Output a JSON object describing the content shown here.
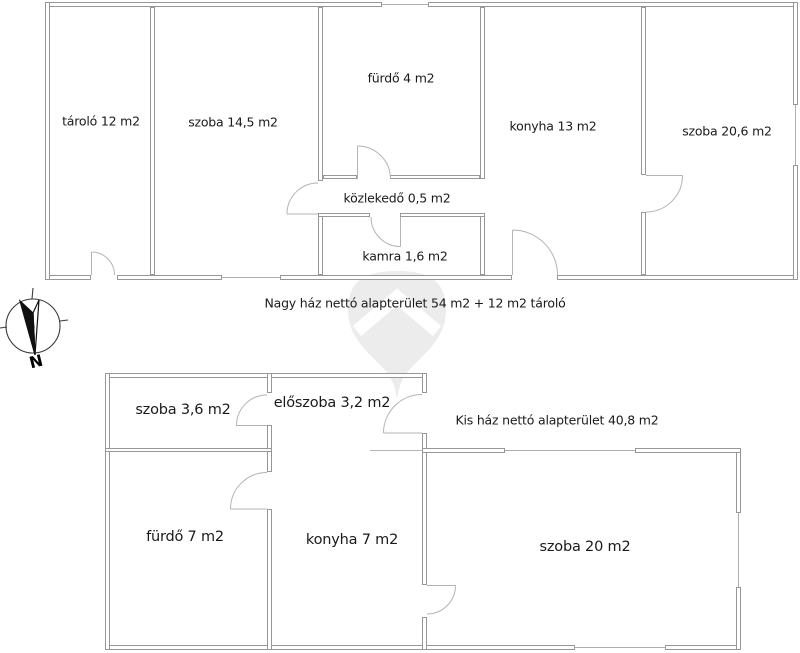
{
  "watermark": {
    "shape_name": "map-pin-watermark",
    "body_color": "#ececec",
    "chevron_color": "#ffffff"
  },
  "compass": {
    "north_label": "N"
  },
  "upper_plan": {
    "caption": "Nagy ház nettó alapterület 54 m2 + 12 m2 tároló",
    "rooms": [
      {
        "label": "tároló 12 m2"
      },
      {
        "label": "szoba 14,5 m2"
      },
      {
        "label": "fürdő 4 m2"
      },
      {
        "label": "közlekedő 0,5 m2"
      },
      {
        "label": "kamra 1,6 m2"
      },
      {
        "label": "konyha 13 m2"
      },
      {
        "label": "szoba 20,6 m2"
      }
    ]
  },
  "lower_plan": {
    "caption": "Kis ház nettó alapterület 40,8 m2",
    "rooms": [
      {
        "label": "szoba 3,6 m2"
      },
      {
        "label": "előszoba 3,2 m2"
      },
      {
        "label": "fürdő 7 m2"
      },
      {
        "label": "konyha 7 m2"
      },
      {
        "label": "szoba 20 m2"
      }
    ]
  }
}
